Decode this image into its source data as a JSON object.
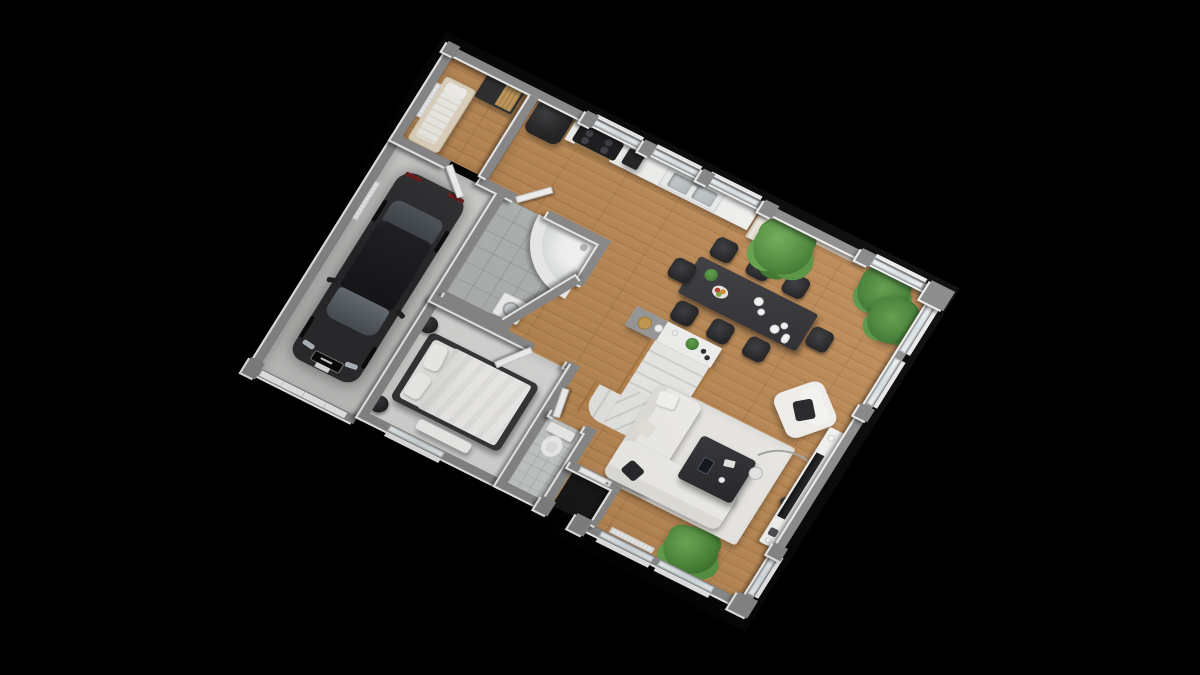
{
  "scene": {
    "description": "3D isometric render of a house ground-floor plan on a black background",
    "background_color": "#000000",
    "view": "isometric top-down, rotated"
  },
  "palette": {
    "wall_top": "#8d8d8d",
    "wall_face": "#f3f3f3",
    "wood_floor": "#bb8751",
    "garage_floor": "#d5d5d3",
    "bathroom_tile": "#b5b9b7",
    "bedroom_carpet": "#e0e1df",
    "cream_wall": "#e9e0cd",
    "oak_accent": "#b98449",
    "furniture_dark": "#2c2c2f",
    "upholstery_white": "#f7f6f2",
    "plant_green": "#4c8a38",
    "car_black": "#2a2a2d"
  },
  "labels": {
    "floorplan": "3D floor plan render",
    "guest_room": "Guest bedroom with single bed and wardrobe",
    "garage": "Garage with parked car",
    "bathroom": "Bathroom with corner bathtub and washing machine",
    "bedroom": "Master bedroom with double bed",
    "wc": "Toilet room",
    "porch": "Recessed entry porch",
    "living": "Open-plan kitchen, dining and living room",
    "hall_wood": "Wood flooring",
    "car": "Black sedan car",
    "single_bed": "Single bed",
    "wardrobe": "Dark wardrobe with oak door",
    "fridge": "Black refrigerator",
    "cooktop": "Black cooktop with oven",
    "small_appliance": "Countertop appliance",
    "kitchen_sink": "Double stainless sink",
    "tall_cabinet": "Tall kitchen cabinet",
    "dining_table": "Black dining table",
    "dining_chair": "Black dining chair",
    "table_decor": "Table decoration",
    "fruit_bowl": "Fruit bowl",
    "plant_large": "Large potted plant",
    "palm_plants": "Potted palm plants",
    "plant_floor": "Potted green plant",
    "console": "Console cabinet with decor",
    "stairs": "Winder staircase with oak railing",
    "double_bed": "Double bed with white duvet",
    "bedside_stool": "Round bedside stool",
    "bench": "Bedroom bench",
    "toilet": "Toilet",
    "bathtub": "Corner bathtub",
    "washer": "Washing machine",
    "rug": "White area rug",
    "sofa": "White corner sofa",
    "pillow": "Throw pillow",
    "armchair": "White armchair",
    "coffee_table": "Black coffee table",
    "floor_lamp": "Arc floor lamp",
    "tv_board": "TV lowboard",
    "tv": "Flat-screen TV",
    "window": "Window",
    "front_door": "Front door",
    "garage_door": "Garage sectional door",
    "interior_door": "Interior door",
    "radiator": "Radiator",
    "wall": "Wall",
    "pier": "Wall pier"
  }
}
